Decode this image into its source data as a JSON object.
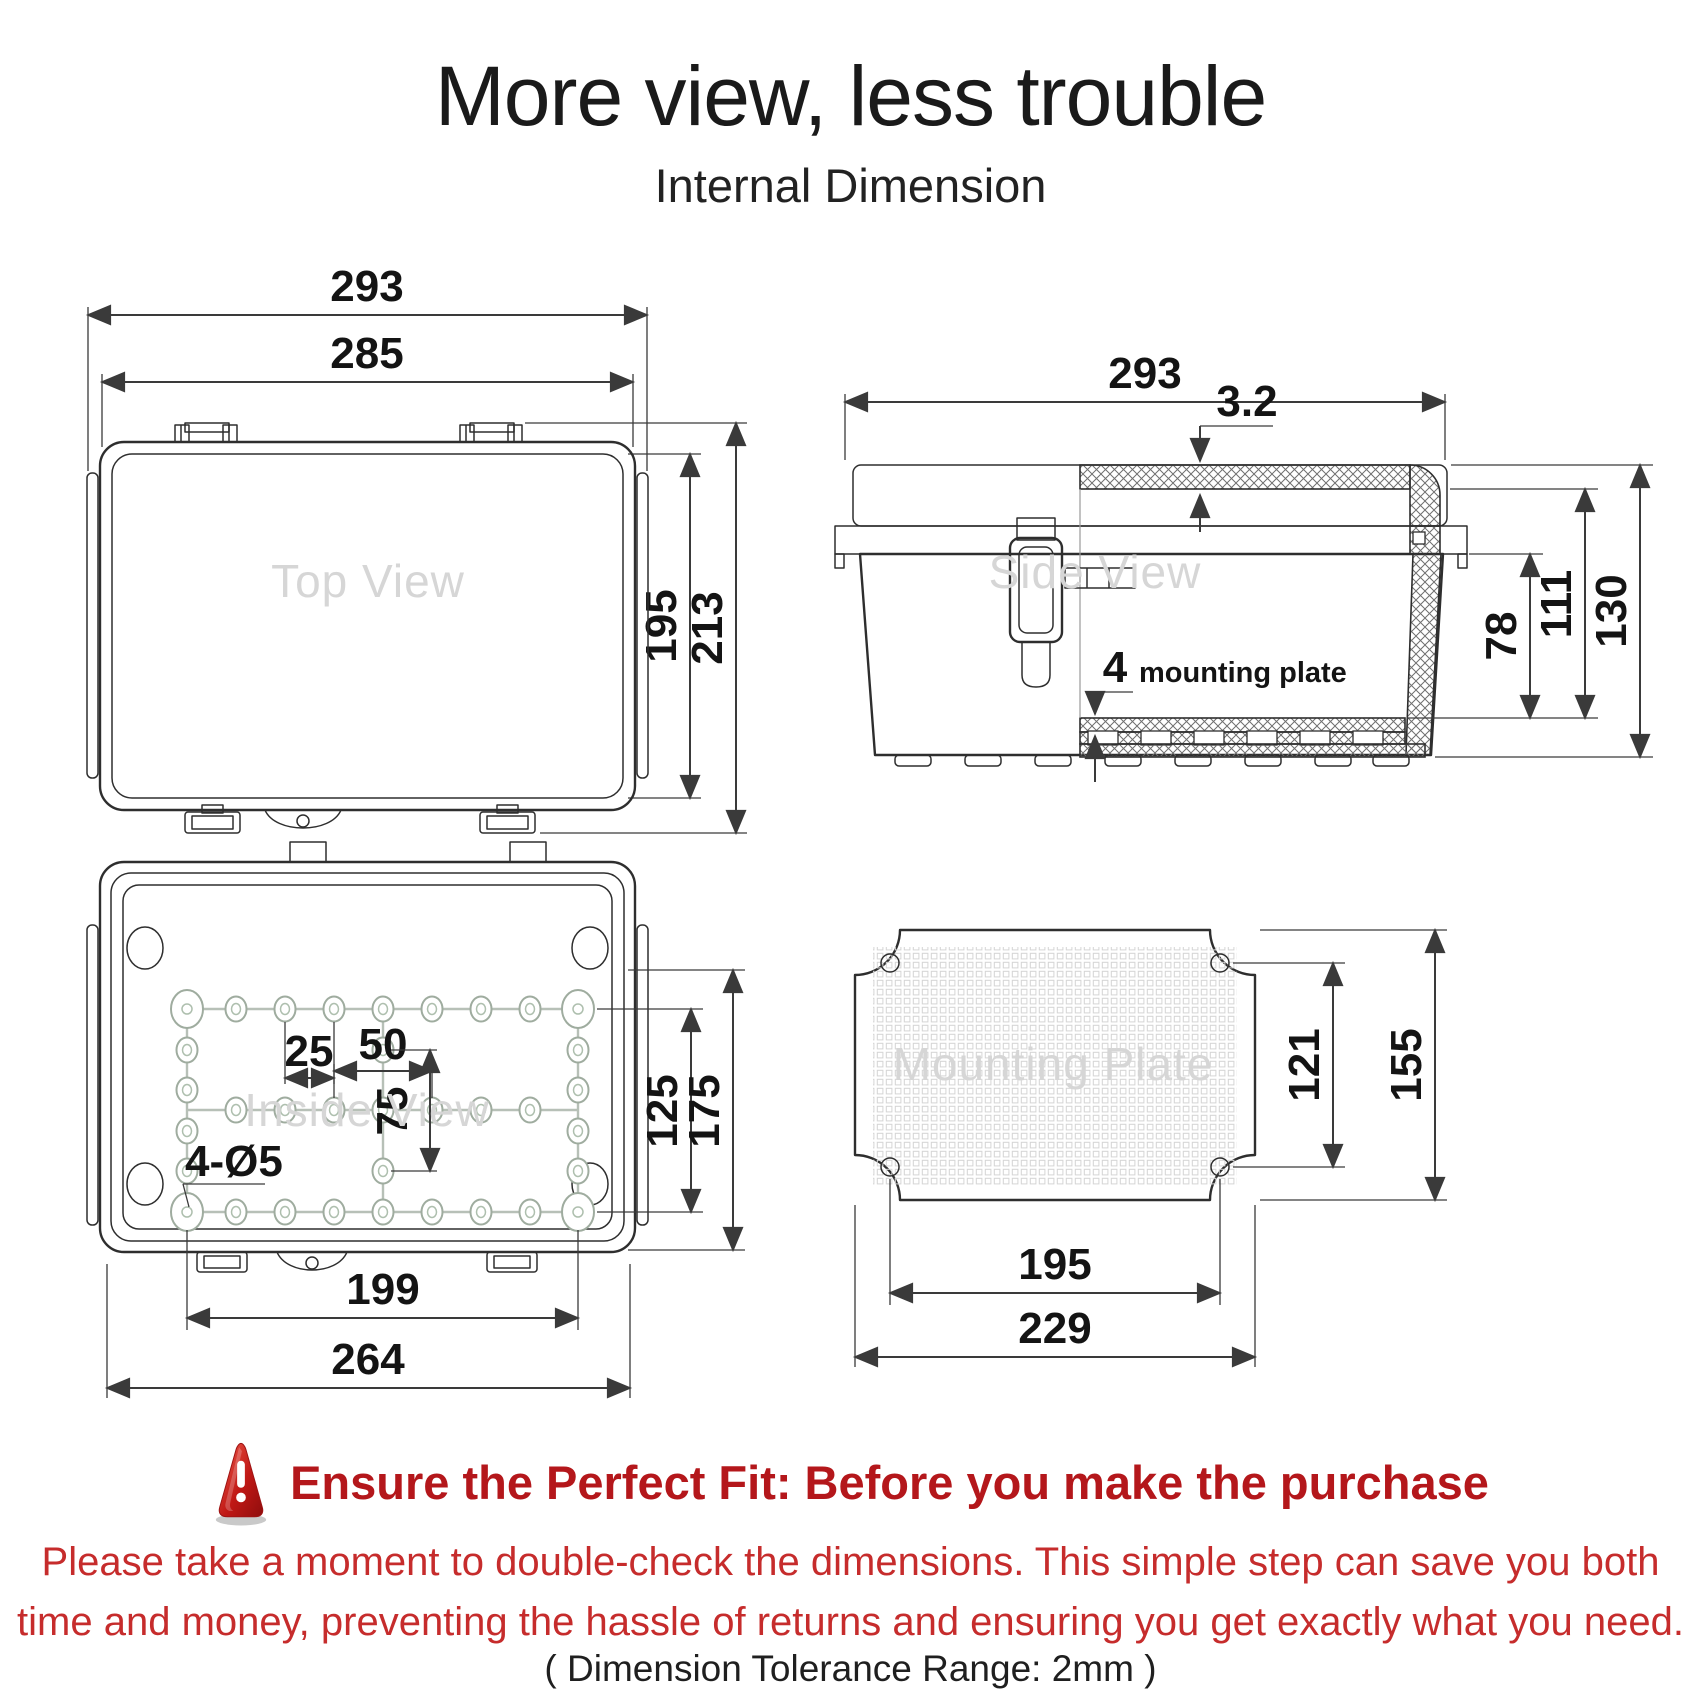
{
  "page": {
    "title": "More view, less trouble",
    "subtitle": "Internal Dimension"
  },
  "views": {
    "top_view": {
      "label": "Top View",
      "dims": {
        "outer_width": "293",
        "lid_width": "285",
        "lid_height": "195",
        "outer_height": "213"
      }
    },
    "side_view": {
      "label": "Side View",
      "dims": {
        "outer_width": "293",
        "wall_thickness": "3.2",
        "plate_thickness": "4",
        "plate_note": "mounting plate",
        "lip_to_plate_depth": "78",
        "inner_depth": "111",
        "outer_depth": "130"
      }
    },
    "inside_view": {
      "label": "Inside View",
      "dims": {
        "boss_pitch": "25",
        "center_pitch_x": "50",
        "center_pitch_y": "75",
        "screw_holes": "4-Ø5",
        "boss_span_y": "125",
        "inner_height": "175",
        "boss_span_x": "199",
        "base_width": "264"
      }
    },
    "mounting_plate": {
      "label": "Mounting Plate",
      "dims": {
        "hole_span_y": "121",
        "plate_height": "155",
        "hole_span_x": "195",
        "plate_width": "229"
      }
    }
  },
  "warning": {
    "heading": "Ensure the Perfect Fit: Before you make the purchase",
    "body_line1": "Please take a moment to double-check the dimensions. This simple step can save you both",
    "body_line2": "time and money, preventing the hassle of returns and ensuring you get exactly what you need.",
    "tolerance_note": "( Dimension Tolerance Range: 2mm )"
  },
  "colors": {
    "heading_red": "#b4171b",
    "body_red": "#c62c2c",
    "text_dark": "#1a1a1a",
    "watermark_gray": "#d6d6d6",
    "line_dark": "#2e2e2e"
  }
}
